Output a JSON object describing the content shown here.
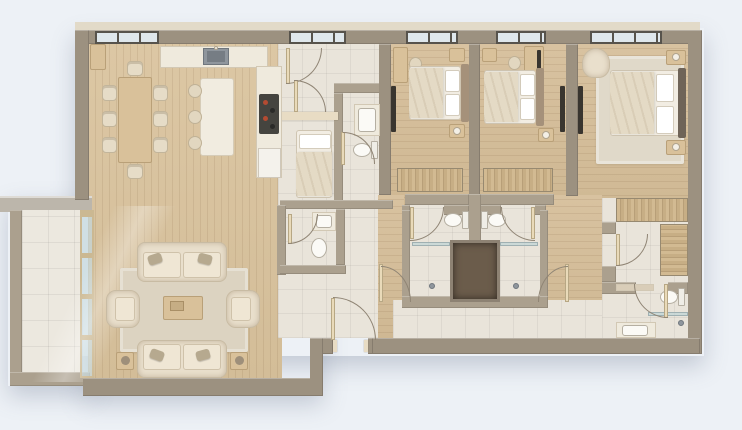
{
  "meta": {
    "title": "Apartment floor plan — photorealistic top-down 3D render",
    "description": "Top-view architectural render of a three-bedroom apartment with open living-dining-kitchen, balcony, hallway, four bathrooms, walk-in closet and master suite on a pale blue background"
  },
  "palette": {
    "background": "#edf1f6",
    "outer_wall": "#9c9180",
    "inner_wall": "#aba08e",
    "wall_cap": "#e8dcc4",
    "wood_floor": "#d7c1a0",
    "tile_floor": "#e9e4da",
    "balcony_tile": "#ece8df",
    "rug": "#dcd3c1",
    "sofa_fabric": "#e9dfcc",
    "accent_pillow": "#b6a98f",
    "counter": "#efeadd",
    "wood_furniture": "#d9c19a",
    "wardrobe_wood": "#c7ae85",
    "white_fixture": "#fbfaf6",
    "sink_metal": "#8f969d",
    "cooktop": "#45443f",
    "burner_red": "#b44b32",
    "shower_niche": "#6b5c4b",
    "window_frame": "#57534c",
    "window_glass": "#dfe7ec",
    "tv_panel": "#39352f"
  },
  "rooms": [
    {
      "id": "balcony",
      "label": "Balcony",
      "items": [
        "tiled floor",
        "glass sliding wall"
      ]
    },
    {
      "id": "living-dining",
      "label": "Living / dining room",
      "items": [
        "dining table",
        "8 dining chairs",
        "kitchen island",
        "3 bar stools",
        "2 sofas",
        "2 armchairs",
        "coffee table",
        "area rug",
        "2 side tables"
      ]
    },
    {
      "id": "kitchen",
      "label": "Kitchen",
      "items": [
        "counter with sink",
        "cooktop counter",
        "base cabinet"
      ]
    },
    {
      "id": "entry-hall",
      "label": "Entry hall / corridor",
      "items": [
        "entry door",
        "interior doors"
      ]
    },
    {
      "id": "utility-room",
      "label": "Utility room",
      "items": [
        "single bed"
      ]
    },
    {
      "id": "bathroom-top",
      "label": "Bathroom",
      "items": [
        "washbasin on shelf",
        "wall-hung toilet"
      ]
    },
    {
      "id": "guest-wc",
      "label": "Guest WC",
      "items": [
        "washbasin",
        "toilet"
      ]
    },
    {
      "id": "bedroom-1",
      "label": "Bedroom 1",
      "items": [
        "double bed",
        "2 nightstands",
        "desk",
        "chair",
        "TV panel",
        "wardrobe"
      ]
    },
    {
      "id": "bedroom-2",
      "label": "Bedroom 2",
      "items": [
        "double bed",
        "2 nightstands",
        "desk",
        "chair",
        "TV panel",
        "wardrobe"
      ]
    },
    {
      "id": "ensuite-left",
      "label": "En-suite shower room (left)",
      "items": [
        "toilet",
        "walk-in shower",
        "glass screen"
      ]
    },
    {
      "id": "ensuite-right",
      "label": "En-suite shower room (right)",
      "items": [
        "toilet",
        "walk-in shower",
        "glass screen"
      ]
    },
    {
      "id": "master-bedroom",
      "label": "Master bedroom",
      "items": [
        "double bed",
        "2 nightstands with lamps",
        "armchair",
        "rug",
        "TV panel"
      ]
    },
    {
      "id": "walk-in-closet",
      "label": "Walk-in closet",
      "items": [
        "wardrobe run",
        "side wardrobe"
      ]
    },
    {
      "id": "master-bathroom",
      "label": "Master bathroom",
      "items": [
        "toilet",
        "walk-in shower",
        "vanity washbasin",
        "shelf"
      ]
    }
  ],
  "windows": {
    "count": 5,
    "location": "top exterior wall"
  }
}
